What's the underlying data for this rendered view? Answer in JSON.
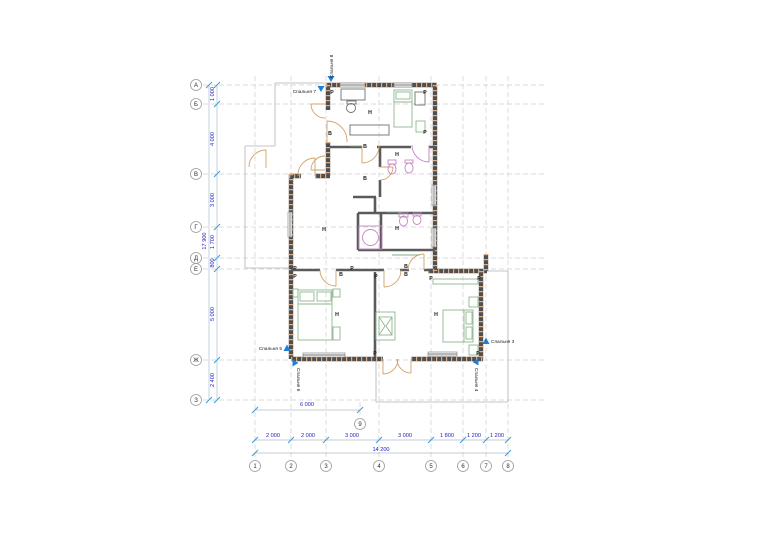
{
  "document": {
    "type": "floor-plan-drawing",
    "background": "#ffffff"
  },
  "colors": {
    "dimension_text": "#2121bd",
    "marker_blue": "#1e7fd6",
    "wall": "#4f4f4f",
    "wall_hatch": "#d8ad82",
    "door": "#d2a36a",
    "furniture_green": "#8fb58f",
    "fixture_magenta": "#c488c4",
    "grid": "#cfcfcf"
  },
  "axes": {
    "rows": [
      {
        "label": "А",
        "y": 85
      },
      {
        "label": "Б",
        "y": 104
      },
      {
        "label": "В",
        "y": 174
      },
      {
        "label": "Г",
        "y": 227
      },
      {
        "label": "Д",
        "y": 258
      },
      {
        "label": "Е",
        "y": 269
      },
      {
        "label": "Ж",
        "y": 360
      },
      {
        "label": "З",
        "y": 400
      }
    ],
    "rows_cx": 196,
    "cols": [
      {
        "label": "1",
        "x": 255
      },
      {
        "label": "2",
        "x": 291
      },
      {
        "label": "3",
        "x": 326
      },
      {
        "label": "4",
        "x": 379
      },
      {
        "label": "5",
        "x": 431
      },
      {
        "label": "6",
        "x": 463
      },
      {
        "label": "7",
        "x": 486
      },
      {
        "label": "8",
        "x": 508
      }
    ],
    "cols_cy": 466,
    "extra_col": {
      "label": "9",
      "x": 360,
      "y": 424
    }
  },
  "dimensions": {
    "left_segments": [
      {
        "text": "1 000",
        "y": 94
      },
      {
        "text": "4 000",
        "y": 139
      },
      {
        "text": "3 000",
        "y": 200
      },
      {
        "text": "1 700",
        "y": 242
      },
      {
        "text": "800",
        "y": 263
      },
      {
        "text": "5 000",
        "y": 314
      },
      {
        "text": "2 400",
        "y": 380
      }
    ],
    "left_total": {
      "text": "17 900",
      "x": 206,
      "y": 241
    },
    "left_seg_text_x": 214,
    "bottom_segments": [
      {
        "text": "2 000",
        "x": 273
      },
      {
        "text": "2 000",
        "x": 308
      },
      {
        "text": "3 000",
        "x": 352
      },
      {
        "text": "3 000",
        "x": 405
      },
      {
        "text": "1 800",
        "x": 447
      },
      {
        "text": "1 200",
        "x": 474
      },
      {
        "text": "1 200",
        "x": 497
      }
    ],
    "bottom_seg_text_y": 437,
    "bottom_total": {
      "text": "14 200",
      "x": 381,
      "y": 451
    },
    "bottom_upper": {
      "text": "6 000",
      "x": 307,
      "y": 406
    }
  },
  "room_markers": [
    {
      "name": "spalnya-8",
      "text": "Спальня 8",
      "tri": [
        331,
        81
      ],
      "dir": "down",
      "tx": 333,
      "ty": 78,
      "rot": -90,
      "anchor": "start"
    },
    {
      "name": "spalnya-7",
      "text": "Спальня 7",
      "tri": [
        321,
        91
      ],
      "dir": "down",
      "tx": 316,
      "ty": 93,
      "rot": 0,
      "anchor": "end"
    },
    {
      "name": "spalnya-5",
      "text": "Спальня 5",
      "tri": [
        287,
        348
      ],
      "dir": "up",
      "tx": 282,
      "ty": 350,
      "rot": 0,
      "anchor": "end"
    },
    {
      "name": "spalnya-6",
      "text": "Спальня 6",
      "tri": [
        295,
        363
      ],
      "dir": "right",
      "tx": 297,
      "ty": 368,
      "rot": 90,
      "anchor": "start"
    },
    {
      "name": "spalnya-3",
      "text": "Спальня 3",
      "tri": [
        486,
        341
      ],
      "dir": "up",
      "tx": 491,
      "ty": 343,
      "rot": 0,
      "anchor": "start"
    },
    {
      "name": "spalnya-4",
      "text": "Спальня 4",
      "tri": [
        476,
        362
      ],
      "dir": "left",
      "tx": 475,
      "ty": 368,
      "rot": 90,
      "anchor": "start"
    }
  ],
  "room_letters": [
    {
      "t": "Н",
      "pts": [
        [
          370,
          114
        ],
        [
          397,
          156
        ],
        [
          324,
          231
        ],
        [
          397,
          230
        ],
        [
          337,
          316
        ],
        [
          436,
          316
        ]
      ]
    },
    {
      "t": "В",
      "pts": [
        [
          330,
          135
        ],
        [
          365,
          148
        ],
        [
          365,
          180
        ],
        [
          341,
          276
        ],
        [
          406,
          268
        ],
        [
          406,
          276
        ]
      ]
    },
    {
      "t": "Р",
      "pts": [
        [
          332,
          94
        ],
        [
          425,
          94
        ],
        [
          425,
          134
        ],
        [
          295,
          270
        ],
        [
          295,
          278
        ],
        [
          352,
          270
        ],
        [
          376,
          278
        ],
        [
          431,
          280
        ],
        [
          479,
          280
        ],
        [
          375,
          355
        ],
        [
          478,
          355
        ]
      ]
    }
  ]
}
